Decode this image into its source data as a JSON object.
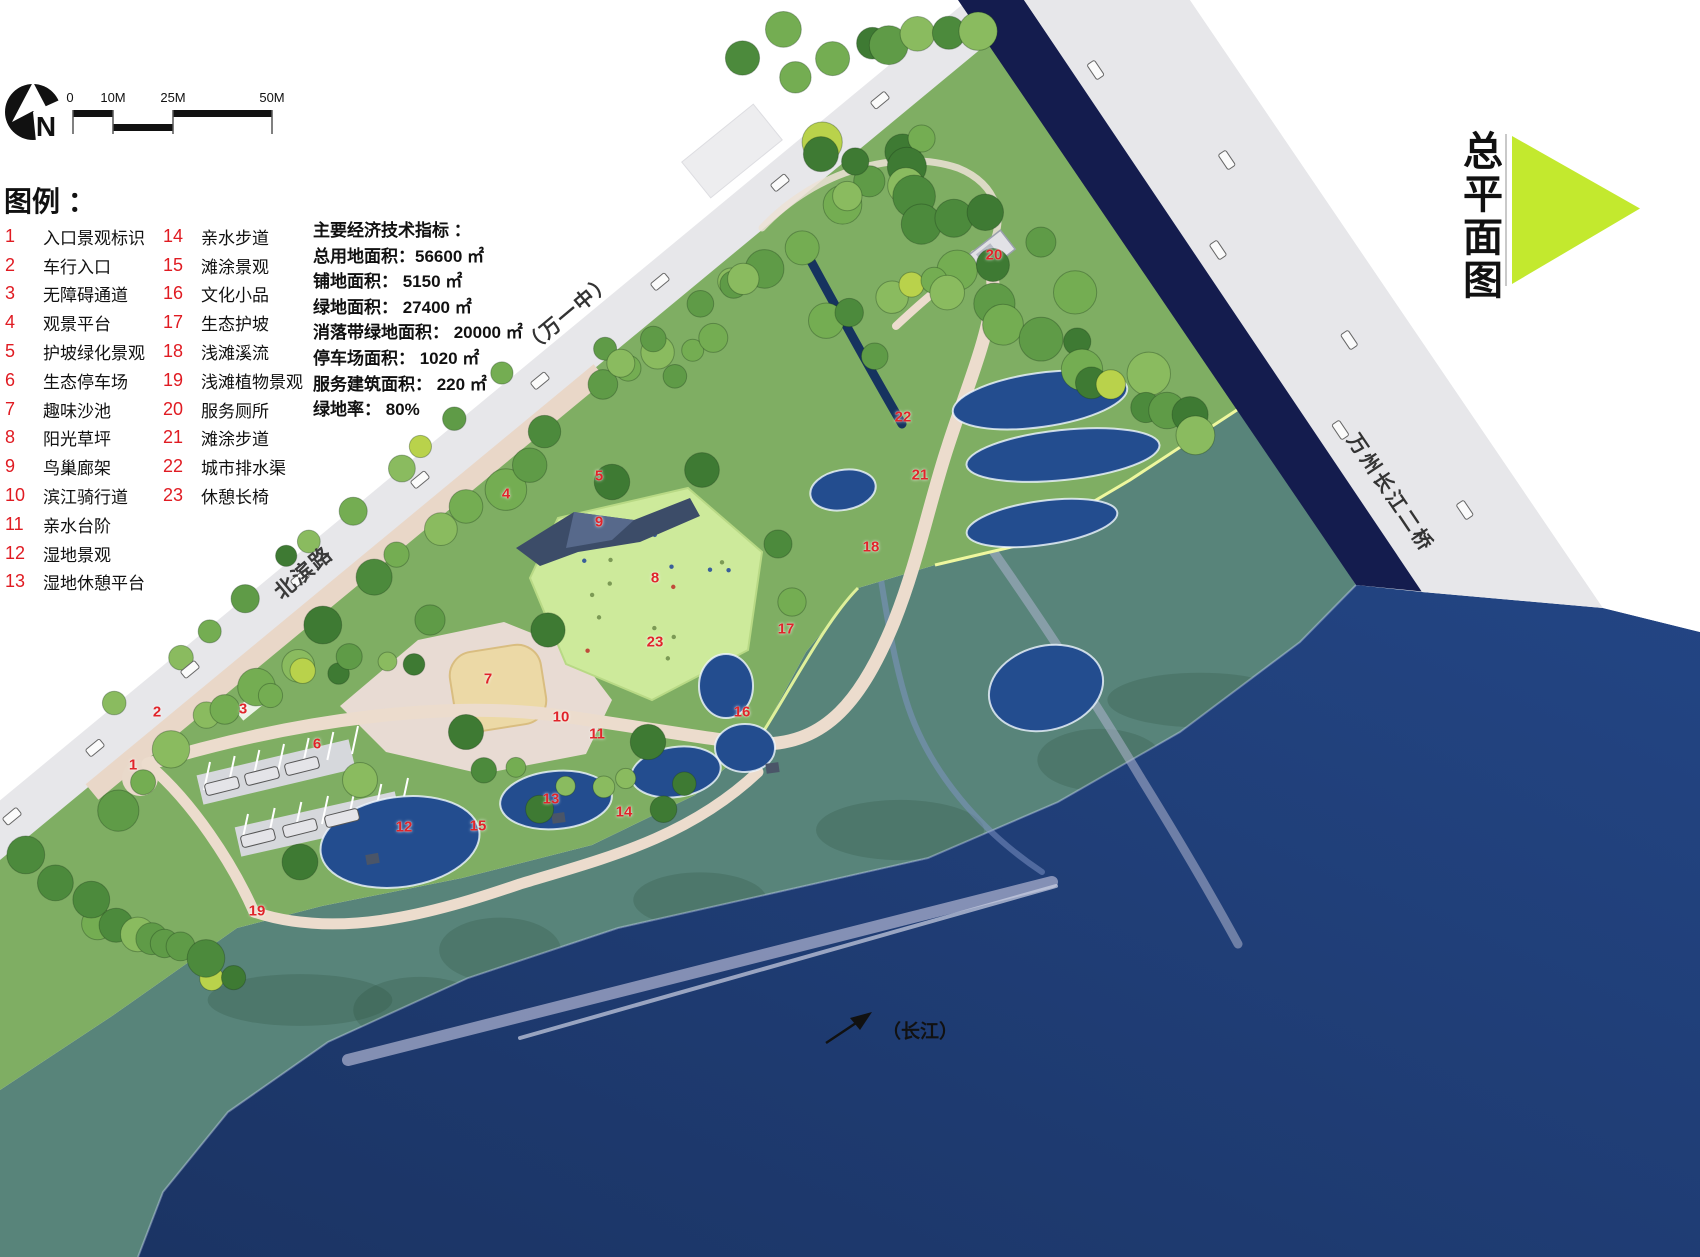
{
  "north": {
    "label": "N"
  },
  "scalebar": {
    "labels": [
      "0",
      "10M",
      "25M",
      "50M"
    ]
  },
  "legend": {
    "title": "图例 ：",
    "col1": [
      {
        "num": "1",
        "label": "入口景观标识"
      },
      {
        "num": "2",
        "label": "车行入口"
      },
      {
        "num": "3",
        "label": "无障碍通道"
      },
      {
        "num": "4",
        "label": "观景平台"
      },
      {
        "num": "5",
        "label": "护坡绿化景观"
      },
      {
        "num": "6",
        "label": "生态停车场"
      },
      {
        "num": "7",
        "label": "趣味沙池"
      },
      {
        "num": "8",
        "label": "阳光草坪"
      },
      {
        "num": "9",
        "label": "鸟巢廊架"
      },
      {
        "num": "10",
        "label": "滨江骑行道"
      },
      {
        "num": "11",
        "label": "亲水台阶"
      },
      {
        "num": "12",
        "label": "湿地景观"
      },
      {
        "num": "13",
        "label": "湿地休憩平台"
      }
    ],
    "col2": [
      {
        "num": "14",
        "label": "亲水步道"
      },
      {
        "num": "15",
        "label": "滩涂景观"
      },
      {
        "num": "16",
        "label": "文化小品"
      },
      {
        "num": "17",
        "label": "生态护坡"
      },
      {
        "num": "18",
        "label": "浅滩溪流"
      },
      {
        "num": "19",
        "label": "浅滩植物景观"
      },
      {
        "num": "20",
        "label": "服务厕所"
      },
      {
        "num": "21",
        "label": "滩涂步道"
      },
      {
        "num": "22",
        "label": "城市排水渠"
      },
      {
        "num": "23",
        "label": "休憩长椅"
      }
    ]
  },
  "indicators": {
    "title": "主要经济技术指标 ：",
    "lines": [
      "总用地面积：56600 ㎡",
      "铺地面积： 5150 ㎡",
      "绿地面积： 27400 ㎡",
      "消落带绿地面积： 20000 ㎡",
      "停车场面积： 1020 ㎡",
      "服务建筑面积： 220 ㎡",
      "绿地率： 80%"
    ]
  },
  "map_labels": {
    "school": "（万一中）",
    "road": "北滨路",
    "bridge": "万州长江二桥",
    "river": "（长江）"
  },
  "plan_title": "总平面图",
  "markers": [
    {
      "n": "1",
      "x": 133,
      "y": 765
    },
    {
      "n": "2",
      "x": 157,
      "y": 712
    },
    {
      "n": "3",
      "x": 243,
      "y": 709
    },
    {
      "n": "4",
      "x": 506,
      "y": 494
    },
    {
      "n": "5",
      "x": 599,
      "y": 476
    },
    {
      "n": "6",
      "x": 317,
      "y": 744
    },
    {
      "n": "7",
      "x": 488,
      "y": 679
    },
    {
      "n": "8",
      "x": 655,
      "y": 578
    },
    {
      "n": "9",
      "x": 599,
      "y": 522
    },
    {
      "n": "10",
      "x": 561,
      "y": 717
    },
    {
      "n": "11",
      "x": 597,
      "y": 734
    },
    {
      "n": "12",
      "x": 404,
      "y": 827
    },
    {
      "n": "13",
      "x": 551,
      "y": 799
    },
    {
      "n": "14",
      "x": 624,
      "y": 812
    },
    {
      "n": "15",
      "x": 478,
      "y": 826
    },
    {
      "n": "16",
      "x": 742,
      "y": 712
    },
    {
      "n": "17",
      "x": 786,
      "y": 629
    },
    {
      "n": "18",
      "x": 871,
      "y": 547
    },
    {
      "n": "19",
      "x": 257,
      "y": 911
    },
    {
      "n": "20",
      "x": 994,
      "y": 255
    },
    {
      "n": "21",
      "x": 920,
      "y": 475
    },
    {
      "n": "22",
      "x": 903,
      "y": 417
    },
    {
      "n": "23",
      "x": 655,
      "y": 642
    }
  ],
  "colors": {
    "accent_triangle": "#c3e92e",
    "marker_red": "#e0242a",
    "deep_water": "#1f3d78",
    "flood_zone": "#58847a",
    "park_green": "#7fae63",
    "lawn": "#cdea9b",
    "bridge_navy": "#141c4e",
    "road_gray": "#e7e7ea",
    "path_tan": "#ecdccd"
  }
}
